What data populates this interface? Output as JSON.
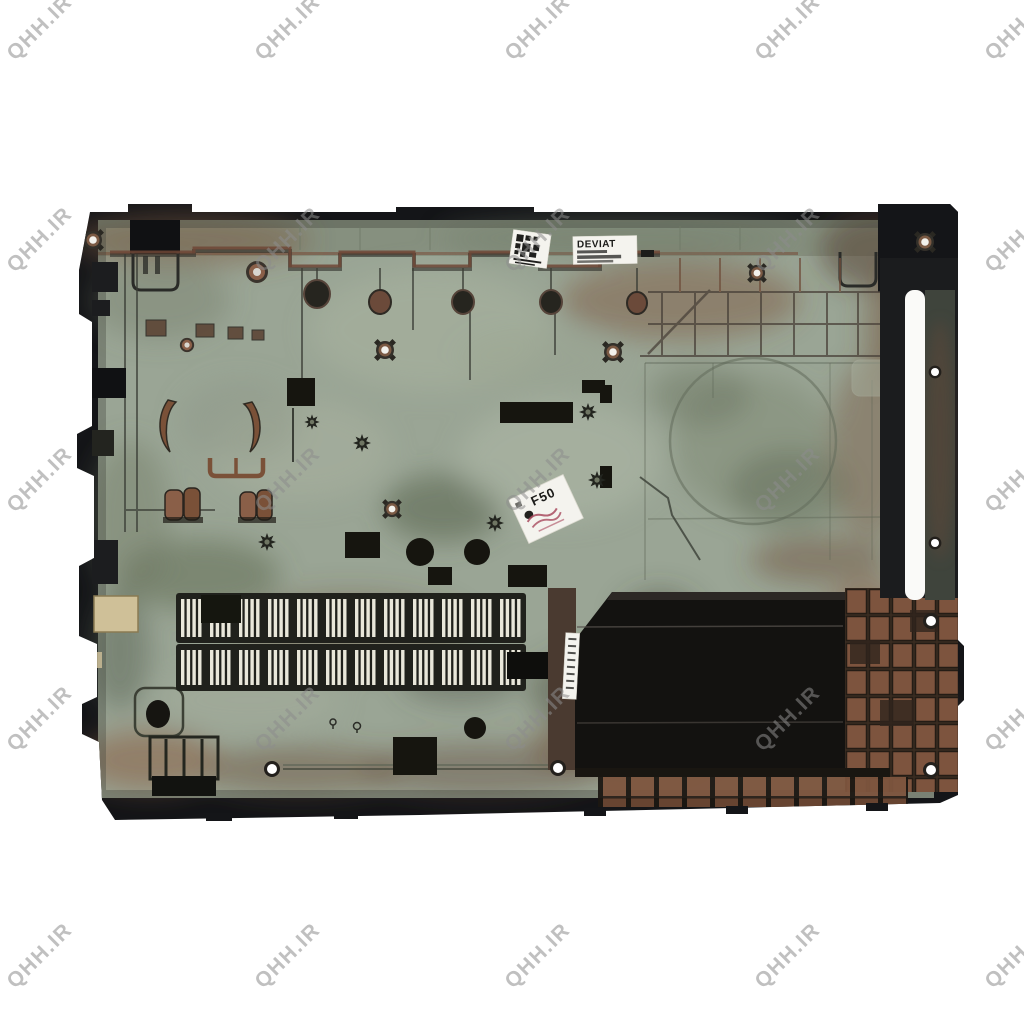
{
  "scene": {
    "description": "Photo of a laptop bottom base cover (inside view) on a white background with tiled diagonal watermarks",
    "background": "#ffffff"
  },
  "watermark": {
    "text": "QHH.IR",
    "color": "#8d8d8d",
    "opacity": 0.55
  },
  "labels": {
    "deviation_sticker": {
      "title": "DEVIAT"
    },
    "qc_sticker": {
      "text": "F50"
    }
  },
  "palette": {
    "background": "#ffffff",
    "rim": "#141518",
    "surface": "#9aa595",
    "surface_dark": "#79836f",
    "copper": "#8f5f46",
    "bay": "#131210",
    "slat": "#e9e7da",
    "sticker": "#f4f3ee",
    "tan": "#cfc098",
    "slot": "#fafaf8"
  }
}
